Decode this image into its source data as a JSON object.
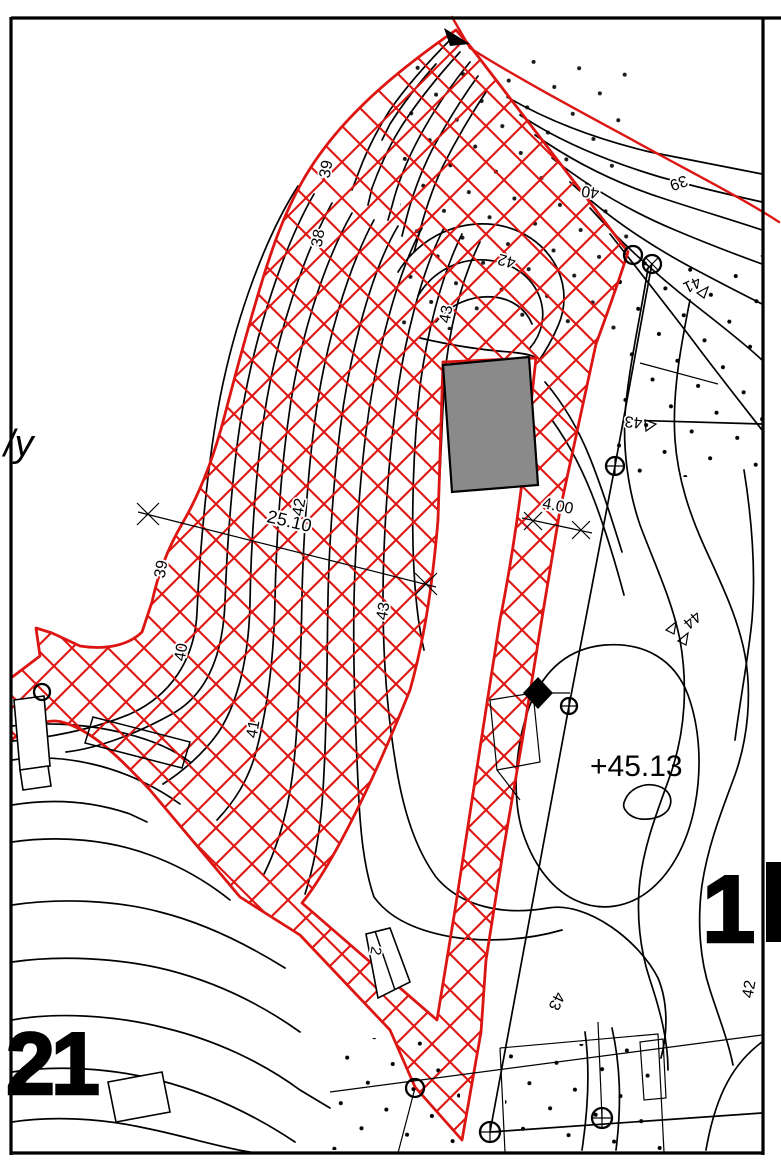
{
  "drawing": {
    "type": "cadastral-topographic-site-plan",
    "colors": {
      "parcel_boundary_red": "#dd1512",
      "contour_black": "#000000",
      "building_fill_gray": "#8a8a8a",
      "paper": "#ffffff"
    },
    "texts": {
      "spot_elevation": "+45.13",
      "parcel_number_left": "21",
      "parcel_number_right": "1",
      "margin_note": "/y",
      "small_building_label": "2"
    },
    "dimensions": [
      {
        "value": "25.10"
      },
      {
        "value": "4.00"
      }
    ],
    "contour_labels": [
      {
        "text": "40"
      },
      {
        "text": "39"
      },
      {
        "text": "39"
      },
      {
        "text": "38"
      },
      {
        "text": "42"
      },
      {
        "text": "43"
      },
      {
        "text": "42"
      },
      {
        "text": "43"
      },
      {
        "text": "39"
      },
      {
        "text": "40"
      },
      {
        "text": "41"
      },
      {
        "text": "41"
      },
      {
        "text": "43"
      },
      {
        "text": "44"
      },
      {
        "text": "43"
      },
      {
        "text": "42"
      }
    ],
    "markers": {
      "open_circle": "survey-point",
      "crossed_circle": "survey-monument",
      "filled_diamond": "boundary-mark"
    }
  }
}
